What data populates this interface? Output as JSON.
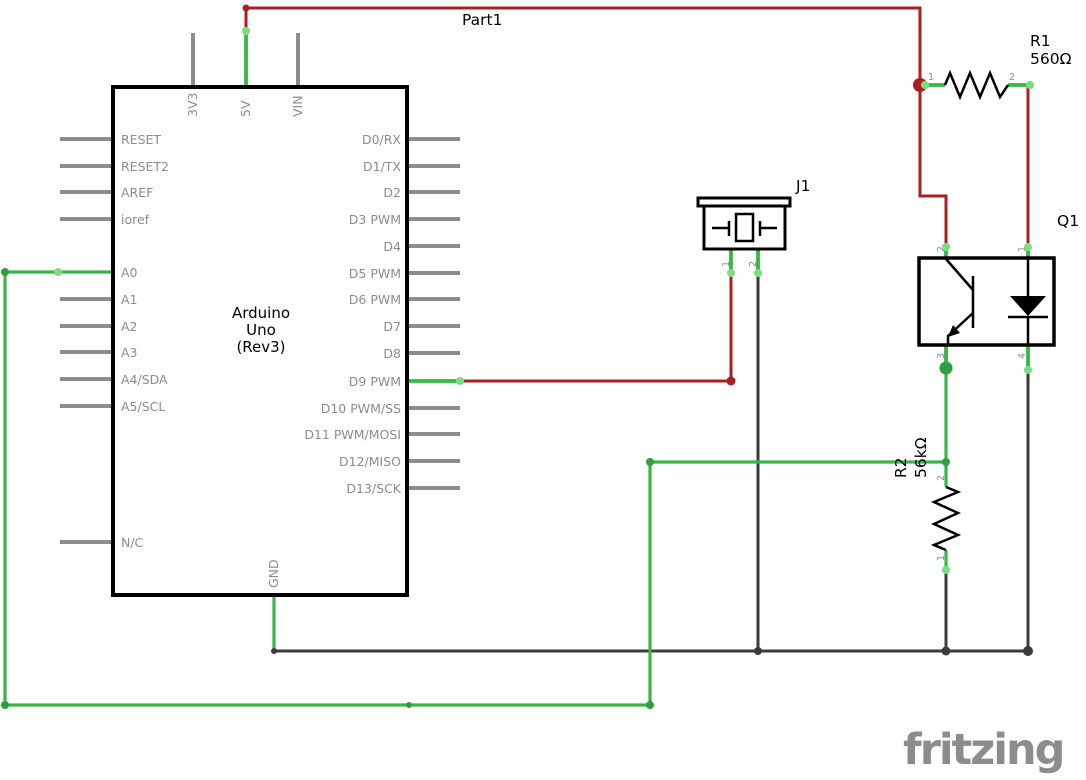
{
  "colors": {
    "wire_red": "#aa2020",
    "wire_green": "#39b54a",
    "wire_green_dark": "#2f9e41",
    "wire_green_tip": "#7ade7e",
    "wire_dark": "#3b3b3b",
    "pin_gray": "#8c8c8c",
    "text_gray": "#8c8c8c",
    "component_black": "#000000",
    "logo_gray": "#8d8c8c"
  },
  "arduino": {
    "part_label": "Part1",
    "name_line1": "Arduino",
    "name_line2": "Uno",
    "name_line3": "(Rev3)",
    "top_pins": [
      "3V3",
      "5V",
      "VIN"
    ],
    "bottom_pins": [
      "GND"
    ],
    "left_pins": [
      "RESET",
      "RESET2",
      "AREF",
      "ioref",
      "A0",
      "A1",
      "A2",
      "A3",
      "A4/SDA",
      "A5/SCL",
      "N/C"
    ],
    "right_pins": [
      "D0/RX",
      "D1/TX",
      "D2",
      "D3 PWM",
      "D4",
      "D5 PWM",
      "D6 PWM",
      "D7",
      "D8",
      "D9 PWM",
      "D10 PWM/SS",
      "D11 PWM/MOSI",
      "D12/MISO",
      "D13/SCK"
    ]
  },
  "r1": {
    "designator": "R1",
    "value": "560Ω",
    "pin_numbers": [
      "1",
      "2"
    ]
  },
  "r2": {
    "designator": "R2",
    "value": "56kΩ",
    "pin_numbers": [
      "2",
      "1"
    ]
  },
  "q1": {
    "designator": "Q1",
    "pin_numbers": [
      "2",
      "1",
      "3",
      "4"
    ]
  },
  "j1": {
    "designator": "J1",
    "pin_numbers": [
      "1",
      "2"
    ]
  },
  "footer": {
    "logo_text": "fritzing"
  }
}
